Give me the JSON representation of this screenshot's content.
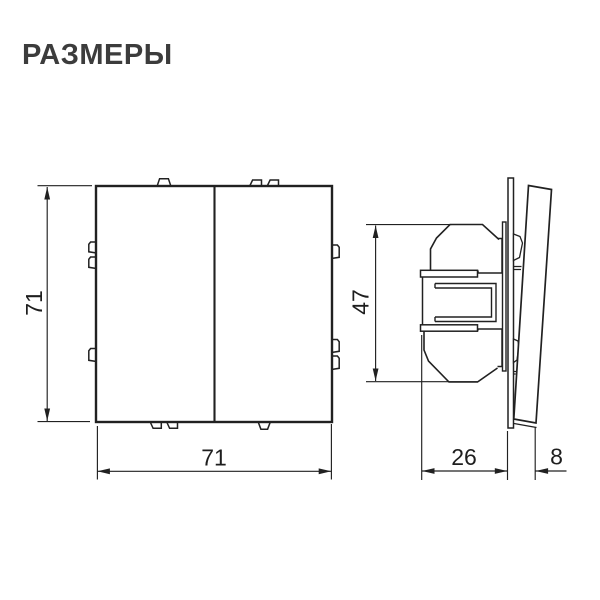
{
  "title": "РАЗМЕРЫ",
  "views": {
    "front": {
      "name": "front-view-two-gang-switch",
      "width": "71",
      "height": "71"
    },
    "side": {
      "name": "side-view-switch-profile",
      "mechanism_height": "47",
      "mounting_depth": "26",
      "front_protrusion": "8"
    }
  },
  "colors": {
    "background": "#ffffff",
    "line": "#212121",
    "dimension_text": "#1e1e1e",
    "title_text": "#3c3c3c"
  }
}
